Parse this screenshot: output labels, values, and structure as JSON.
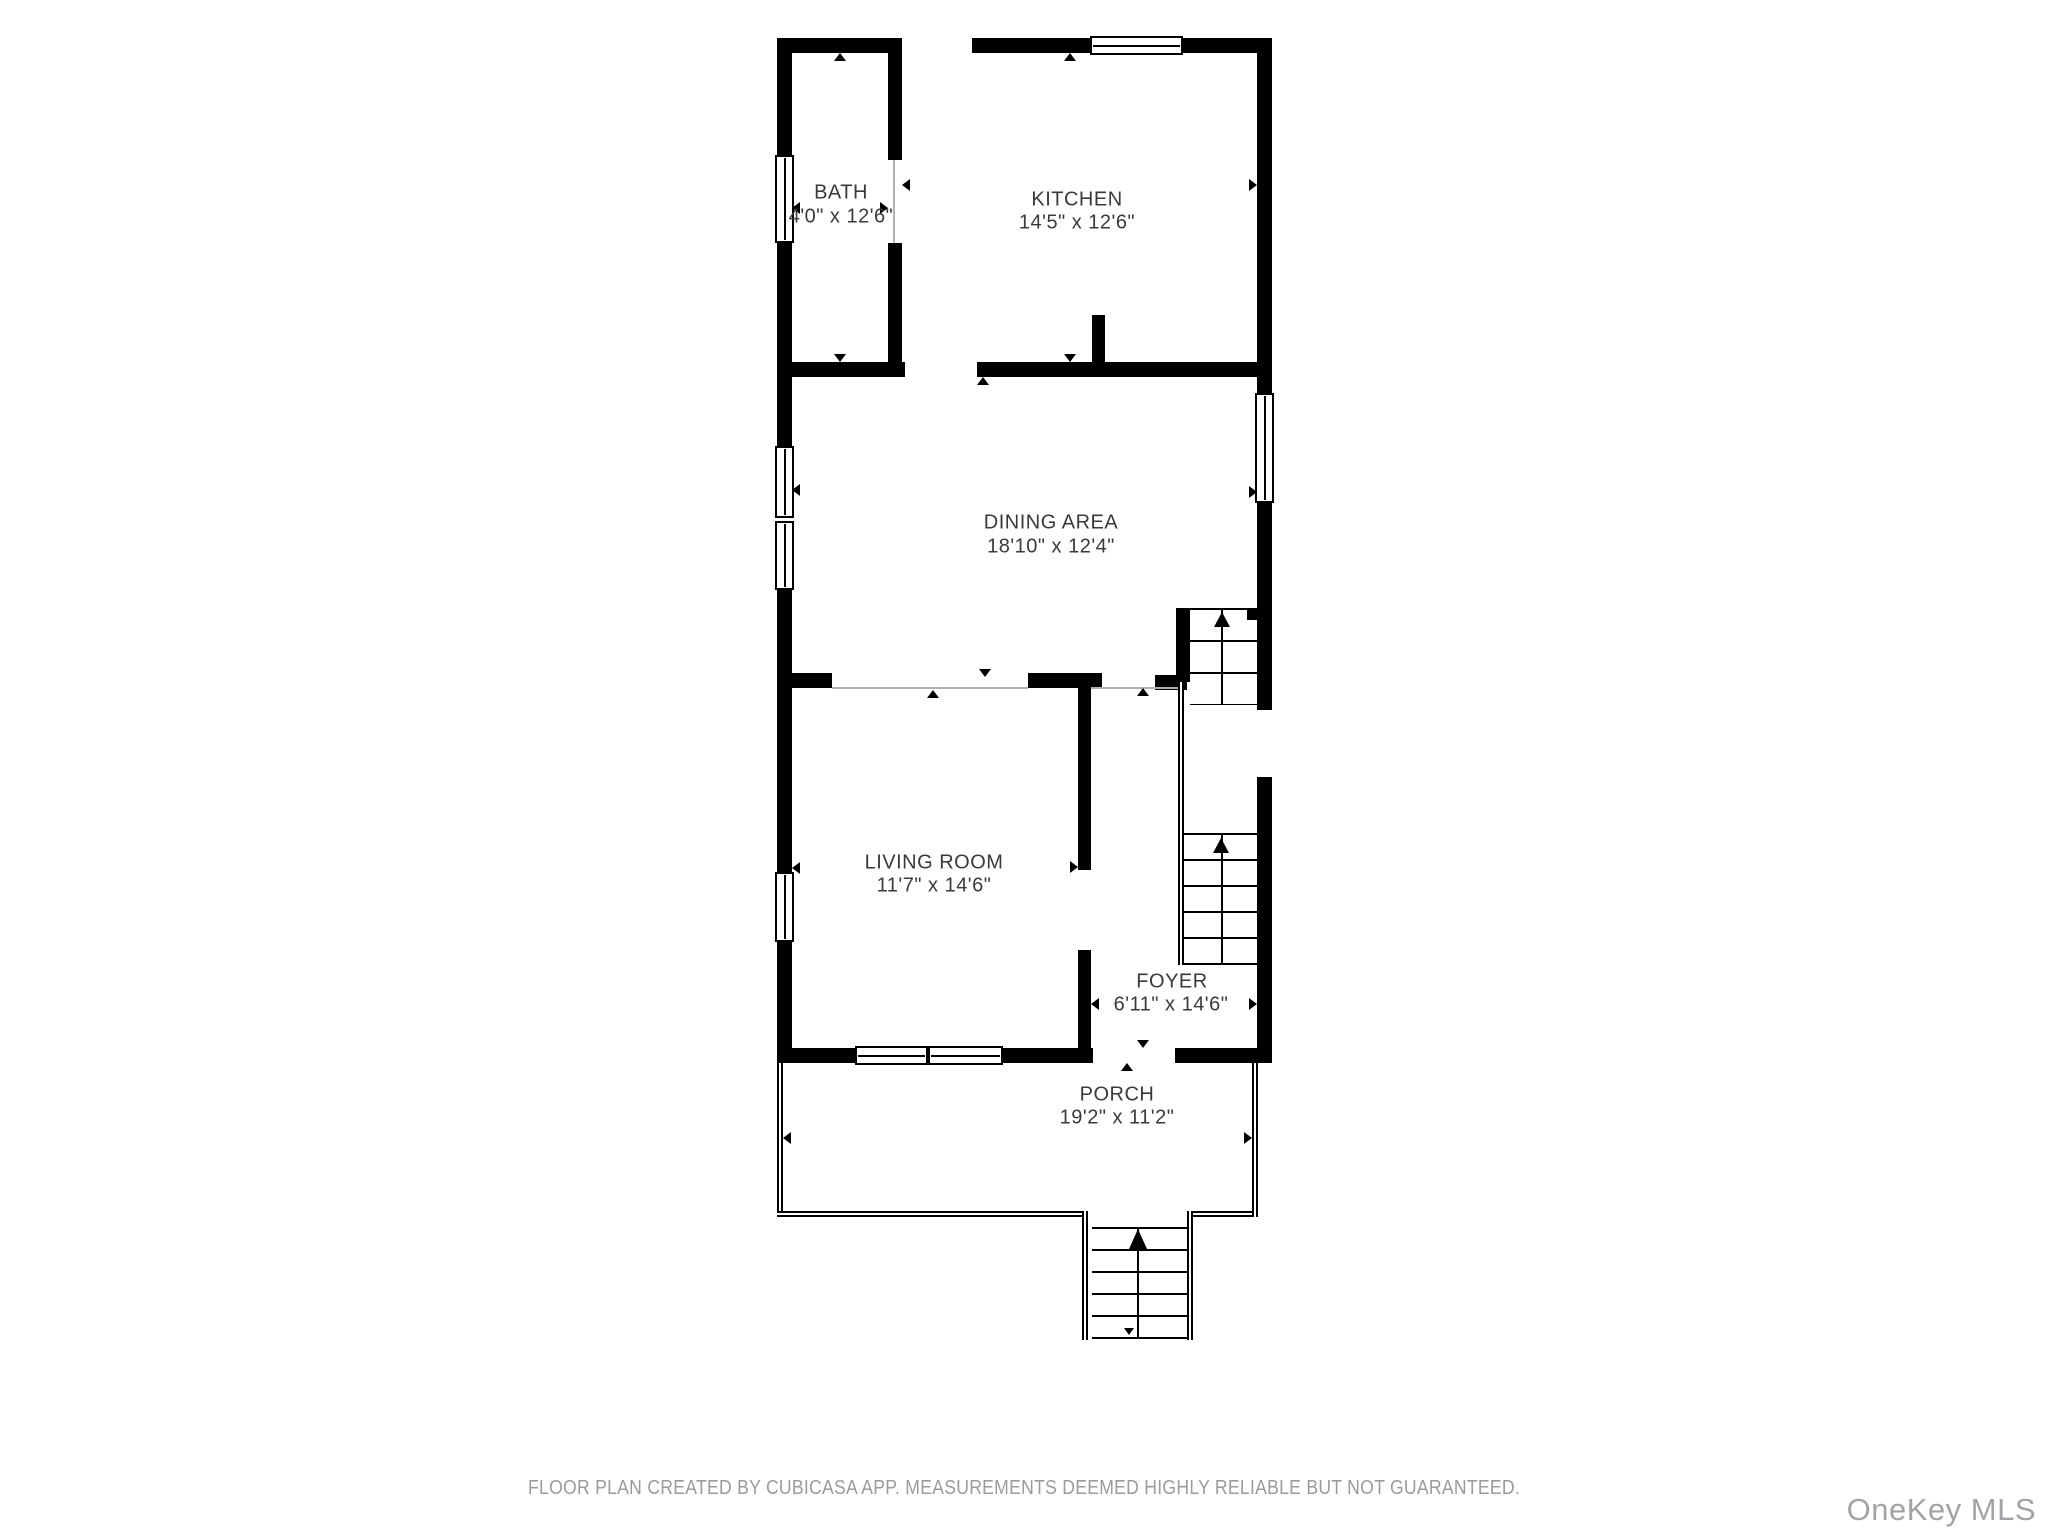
{
  "rooms": {
    "bath": {
      "name": "BATH",
      "dims": "4'0\" x 12'6\""
    },
    "kitchen": {
      "name": "KITCHEN",
      "dims": "14'5\" x 12'6\""
    },
    "dining": {
      "name": "DINING AREA",
      "dims": "18'10\" x 12'4\""
    },
    "living": {
      "name": "LIVING ROOM",
      "dims": "11'7\" x 14'6\""
    },
    "foyer": {
      "name": "FOYER",
      "dims": "6'11\" x 14'6\""
    },
    "porch": {
      "name": "PORCH",
      "dims": "19'2\" x 11'2\""
    }
  },
  "footer": {
    "disclaimer": "FLOOR PLAN CREATED BY CUBICASA APP. MEASUREMENTS DEEMED HIGHLY RELIABLE BUT NOT GUARANTEED."
  },
  "watermark": {
    "text": "OneKey MLS"
  },
  "colors": {
    "page": "#ffffff",
    "wall": "#000000",
    "label": "#3a3a3a",
    "threshold": "#b0b0b0",
    "footer": "#9b9b9b",
    "watermark": "#a1a3a8"
  }
}
